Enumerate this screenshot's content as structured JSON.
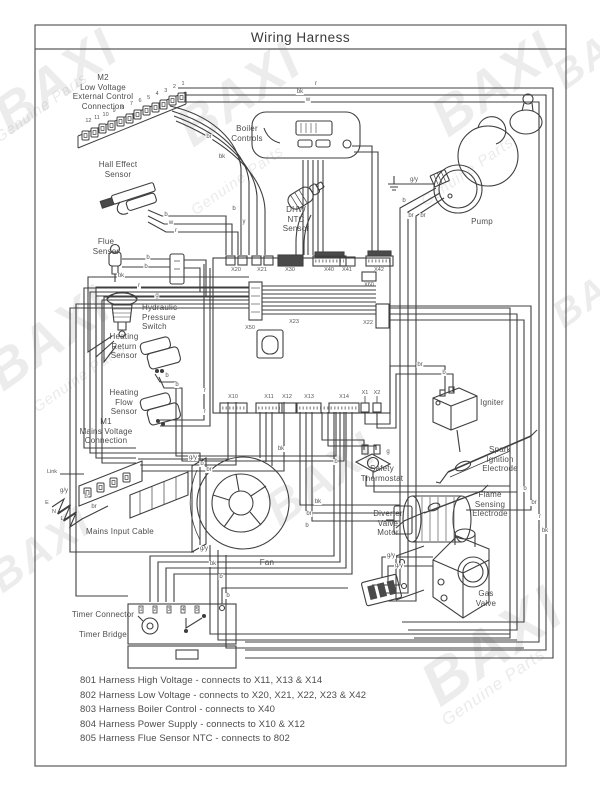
{
  "title": "Wiring Harness",
  "watermark": {
    "brand": "BAXI",
    "tagline": "Genuine Parts"
  },
  "component_labels": [
    {
      "id": "m2-connection",
      "x": 103,
      "y": 73,
      "align": "center",
      "lines": [
        "M2",
        "Low Voltage",
        "External Control",
        "Connection"
      ]
    },
    {
      "id": "boiler-controls",
      "x": 247,
      "y": 124,
      "align": "center",
      "lines": [
        "Boiler",
        "Controls"
      ]
    },
    {
      "id": "hall-effect-sensor",
      "x": 118,
      "y": 160,
      "align": "center",
      "lines": [
        "Hall Effect",
        "Sensor"
      ]
    },
    {
      "id": "dhw-ntc-sensor",
      "x": 296,
      "y": 205,
      "align": "center",
      "lines": [
        "DHW",
        "NTC",
        "Sensor"
      ]
    },
    {
      "id": "pump",
      "x": 482,
      "y": 217,
      "align": "center",
      "lines": [
        "Pump"
      ]
    },
    {
      "id": "flue-sensor",
      "x": 106,
      "y": 237,
      "align": "center",
      "lines": [
        "Flue",
        "Sensor"
      ]
    },
    {
      "id": "hydraulic-pressure-switch",
      "x": 142,
      "y": 303,
      "align": "left",
      "lines": [
        "Hydraulic",
        "Pressure",
        "Switch"
      ]
    },
    {
      "id": "heating-return-sensor",
      "x": 124,
      "y": 332,
      "align": "center",
      "lines": [
        "Heating",
        "Return",
        "Sensor"
      ]
    },
    {
      "id": "heating-flow-sensor",
      "x": 124,
      "y": 388,
      "align": "center",
      "lines": [
        "Heating",
        "Flow",
        "Sensor"
      ]
    },
    {
      "id": "m1-connection",
      "x": 106,
      "y": 417,
      "align": "center",
      "lines": [
        "M1",
        "Mains Voltage",
        "Connection"
      ]
    },
    {
      "id": "mains-input-cable",
      "x": 120,
      "y": 527,
      "align": "center",
      "lines": [
        "Mains Input Cable"
      ]
    },
    {
      "id": "safety-thermostat",
      "x": 382,
      "y": 464,
      "align": "center",
      "lines": [
        "Safety",
        "Thermostat"
      ]
    },
    {
      "id": "diverter-valve-motor",
      "x": 388,
      "y": 509,
      "align": "center",
      "lines": [
        "Diverter",
        "Valve",
        "Motor"
      ]
    },
    {
      "id": "fan",
      "x": 267,
      "y": 558,
      "align": "center",
      "lines": [
        "Fan"
      ]
    },
    {
      "id": "igniter",
      "x": 492,
      "y": 398,
      "align": "center",
      "lines": [
        "Igniter"
      ]
    },
    {
      "id": "spark-ignition-electrode",
      "x": 500,
      "y": 445,
      "align": "center",
      "lines": [
        "Spark",
        "Ignition",
        "Electrode"
      ]
    },
    {
      "id": "flame-sensing-electrode",
      "x": 490,
      "y": 490,
      "align": "center",
      "lines": [
        "Flame",
        "Sensing",
        "Electrode"
      ]
    },
    {
      "id": "gas-valve",
      "x": 486,
      "y": 589,
      "align": "center",
      "lines": [
        "Gas",
        "Valve"
      ]
    },
    {
      "id": "timer-connector",
      "x": 103,
      "y": 610,
      "align": "center",
      "lines": [
        "Timer Connector"
      ]
    },
    {
      "id": "timer-bridge",
      "x": 103,
      "y": 630,
      "align": "center",
      "lines": [
        "Timer Bridge"
      ]
    }
  ],
  "terminal_labels": [
    {
      "t": "Link",
      "x": 52,
      "y": 472
    },
    {
      "t": "E",
      "x": 47,
      "y": 503
    },
    {
      "t": "N",
      "x": 54,
      "y": 512
    },
    {
      "t": "L",
      "x": 62,
      "y": 519
    }
  ],
  "pcb_connectors": [
    {
      "label": "X20",
      "x": 236,
      "y": 267
    },
    {
      "label": "X21",
      "x": 262,
      "y": 267
    },
    {
      "label": "X30",
      "x": 290,
      "y": 267
    },
    {
      "label": "X40",
      "x": 329,
      "y": 267
    },
    {
      "label": "X41",
      "x": 347,
      "y": 267
    },
    {
      "label": "X42",
      "x": 379,
      "y": 267
    },
    {
      "label": "X60",
      "x": 369,
      "y": 282
    },
    {
      "label": "X23",
      "x": 294,
      "y": 319
    },
    {
      "label": "X50",
      "x": 250,
      "y": 325
    },
    {
      "label": "X22",
      "x": 368,
      "y": 320
    },
    {
      "label": "X10",
      "x": 233,
      "y": 394
    },
    {
      "label": "X11",
      "x": 269,
      "y": 394
    },
    {
      "label": "X12",
      "x": 287,
      "y": 394
    },
    {
      "label": "X13",
      "x": 309,
      "y": 394
    },
    {
      "label": "X14",
      "x": 344,
      "y": 394
    },
    {
      "label": "X1",
      "x": 365,
      "y": 390
    },
    {
      "label": "X2",
      "x": 377,
      "y": 390
    }
  ],
  "wire_labels": [
    {
      "t": "r",
      "x": 316,
      "y": 84
    },
    {
      "t": "bk",
      "x": 300,
      "y": 92
    },
    {
      "t": "w",
      "x": 308,
      "y": 100
    },
    {
      "t": "br",
      "x": 209,
      "y": 137
    },
    {
      "t": "bk",
      "x": 222,
      "y": 157
    },
    {
      "t": "b",
      "x": 234,
      "y": 209
    },
    {
      "t": "y",
      "x": 244,
      "y": 222
    },
    {
      "t": "b",
      "x": 166,
      "y": 215
    },
    {
      "t": "w",
      "x": 171,
      "y": 223
    },
    {
      "t": "r",
      "x": 176,
      "y": 231
    },
    {
      "t": "b",
      "x": 148,
      "y": 258
    },
    {
      "t": "b",
      "x": 146,
      "y": 267
    },
    {
      "t": "bk",
      "x": 121,
      "y": 276
    },
    {
      "t": "r",
      "x": 139,
      "y": 286
    },
    {
      "t": "g",
      "x": 157,
      "y": 296
    },
    {
      "t": "b",
      "x": 167,
      "y": 376
    },
    {
      "t": "b",
      "x": 177,
      "y": 385
    },
    {
      "t": "r",
      "x": 205,
      "y": 391
    },
    {
      "t": "r",
      "x": 205,
      "y": 412
    },
    {
      "t": "g/y",
      "x": 193,
      "y": 458
    },
    {
      "t": "b",
      "x": 202,
      "y": 464
    },
    {
      "t": "br",
      "x": 209,
      "y": 470
    },
    {
      "t": "g/y",
      "x": 64,
      "y": 491
    },
    {
      "t": "b",
      "x": 86,
      "y": 497
    },
    {
      "t": "br",
      "x": 94,
      "y": 507
    },
    {
      "t": "g/y",
      "x": 414,
      "y": 180
    },
    {
      "t": "b",
      "x": 404,
      "y": 201
    },
    {
      "t": "br",
      "x": 411,
      "y": 216
    },
    {
      "t": "br",
      "x": 423,
      "y": 216
    },
    {
      "t": "br",
      "x": 420,
      "y": 365
    },
    {
      "t": "b",
      "x": 444,
      "y": 373
    },
    {
      "t": "b",
      "x": 525,
      "y": 489
    },
    {
      "t": "br",
      "x": 534,
      "y": 503
    },
    {
      "t": "r",
      "x": 540,
      "y": 517
    },
    {
      "t": "bk",
      "x": 545,
      "y": 531
    },
    {
      "t": "bk",
      "x": 281,
      "y": 449
    },
    {
      "t": "g",
      "x": 388,
      "y": 452
    },
    {
      "t": "b",
      "x": 336,
      "y": 462
    },
    {
      "t": "bk",
      "x": 318,
      "y": 502
    },
    {
      "t": "br",
      "x": 309,
      "y": 514
    },
    {
      "t": "b",
      "x": 307,
      "y": 526
    },
    {
      "t": "g/y",
      "x": 204,
      "y": 549
    },
    {
      "t": "bk",
      "x": 213,
      "y": 564
    },
    {
      "t": "b",
      "x": 221,
      "y": 577
    },
    {
      "t": "g/y",
      "x": 391,
      "y": 556
    },
    {
      "t": "g/y",
      "x": 399,
      "y": 566
    },
    {
      "t": "b",
      "x": 228,
      "y": 596
    }
  ],
  "m2_terminal_numbers": [
    "1",
    "2",
    "3",
    "4",
    "5",
    "6",
    "7",
    "8",
    "9",
    "10",
    "11",
    "12"
  ],
  "timer_terminal_numbers": [
    "1",
    "2",
    "3",
    "4",
    "5"
  ],
  "legend": [
    "801 Harness High Voltage - connects to X11, X13 & X14",
    "802 Harness Low Voltage - connects to X20, X21, X22, X23 & X42",
    "803 Harness Boiler Control - connects to X40",
    "804 Harness Power Supply - connects to X10 & X12",
    "805 Harness Flue Sensor NTC - connects to 802"
  ]
}
